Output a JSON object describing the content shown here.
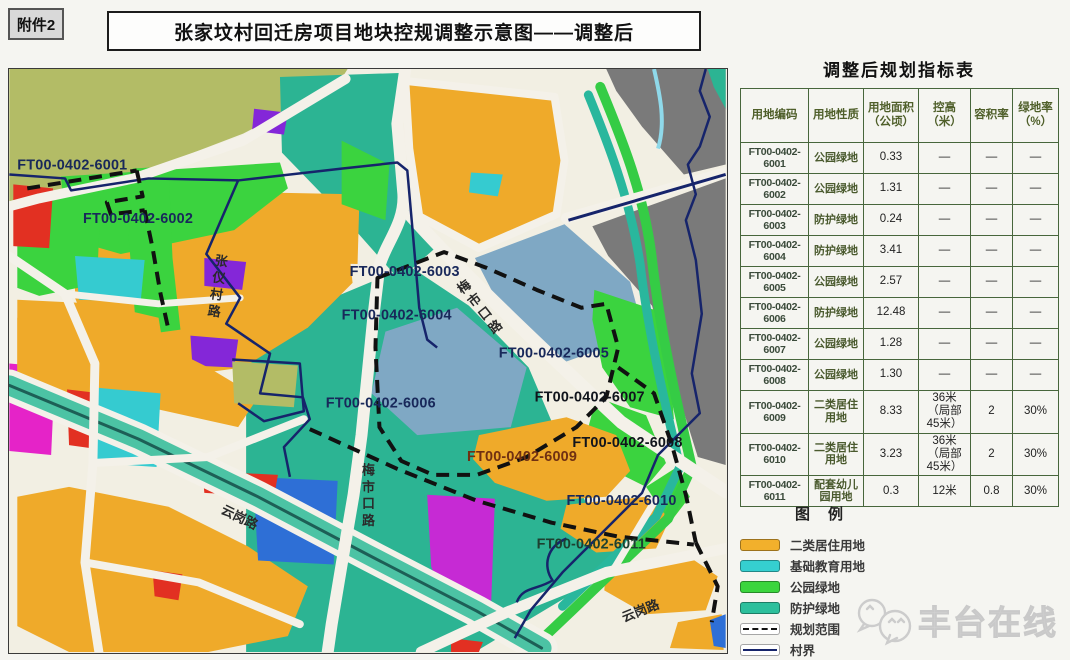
{
  "page": {
    "attachment_label": "附件2",
    "title": "张家坟村回迁房项目地块控规调整示意图——调整后"
  },
  "map": {
    "plot_labels": [
      {
        "text": "FT00-0402-6001",
        "x": 8,
        "y": 101,
        "color": "#18285a"
      },
      {
        "text": "FT00-0402-6002",
        "x": 74,
        "y": 155,
        "color": "#18285a"
      },
      {
        "text": "FT00-0402-6003",
        "x": 342,
        "y": 208,
        "color": "#18285a"
      },
      {
        "text": "FT00-0402-6004",
        "x": 334,
        "y": 252,
        "color": "#18285a"
      },
      {
        "text": "FT00-0402-6005",
        "x": 492,
        "y": 290,
        "color": "#18285a"
      },
      {
        "text": "FT00-0402-6006",
        "x": 318,
        "y": 340,
        "color": "#18285a"
      },
      {
        "text": "FT00-0402-6007",
        "x": 528,
        "y": 334,
        "color": "#10141c"
      },
      {
        "text": "FT00-0402-6008",
        "x": 566,
        "y": 380,
        "color": "#10141c"
      },
      {
        "text": "FT00-0402-6009",
        "x": 460,
        "y": 394,
        "color": "#703012"
      },
      {
        "text": "FT00-0402-6010",
        "x": 560,
        "y": 438,
        "color": "#18285a"
      },
      {
        "text": "FT00-0402-6011",
        "x": 530,
        "y": 482,
        "color": "#1d4030"
      }
    ],
    "road_labels": [
      {
        "text": "张仪村路",
        "x": 213,
        "y": 186,
        "rotate": 8,
        "vertical": true
      },
      {
        "text": "梅市口路",
        "x": 452,
        "y": 214,
        "rotate": -38,
        "vertical": true
      },
      {
        "text": "梅市口路",
        "x": 360,
        "y": 396,
        "rotate": 0,
        "vertical": true
      },
      {
        "text": "云岗路",
        "x": 618,
        "y": 556,
        "rotate": -22,
        "vertical": false
      },
      {
        "text": "云岗路",
        "x": 212,
        "y": 446,
        "rotate": 26,
        "vertical": false
      }
    ]
  },
  "panel": {
    "table_title": "调整后规划指标表",
    "table": {
      "headers": [
        "用地编码",
        "用地性质",
        "用地面积（公顷）",
        "控高（米）",
        "容积率",
        "绿地率（%）"
      ],
      "rows": [
        [
          "FT00-0402-6001",
          "公园绿地",
          "0.33",
          "—",
          "—",
          "—"
        ],
        [
          "FT00-0402-6002",
          "公园绿地",
          "1.31",
          "—",
          "—",
          "—"
        ],
        [
          "FT00-0402-6003",
          "防护绿地",
          "0.24",
          "—",
          "—",
          "—"
        ],
        [
          "FT00-0402-6004",
          "防护绿地",
          "3.41",
          "—",
          "—",
          "—"
        ],
        [
          "FT00-0402-6005",
          "公园绿地",
          "2.57",
          "—",
          "—",
          "—"
        ],
        [
          "FT00-0402-6006",
          "防护绿地",
          "12.48",
          "—",
          "—",
          "—"
        ],
        [
          "FT00-0402-6007",
          "公园绿地",
          "1.28",
          "—",
          "—",
          "—"
        ],
        [
          "FT00-0402-6008",
          "公园绿地",
          "1.30",
          "—",
          "—",
          "—"
        ],
        [
          "FT00-0402-6009",
          "二类居住用地",
          "8.33",
          "36米（局部45米）",
          "2",
          "30%"
        ],
        [
          "FT00-0402-6010",
          "二类居住用地",
          "3.23",
          "36米（局部45米）",
          "2",
          "30%"
        ],
        [
          "FT00-0402-6011",
          "配套幼儿园用地",
          "0.3",
          "12米",
          "0.8",
          "30%"
        ]
      ]
    },
    "legend": {
      "title": "图例",
      "items": [
        {
          "label": "二类居住用地",
          "type": "fill",
          "color": "#f2b02c"
        },
        {
          "label": "基础教育用地",
          "type": "fill",
          "color": "#35cfd0"
        },
        {
          "label": "公园绿地",
          "type": "fill",
          "color": "#3bd53e"
        },
        {
          "label": "防护绿地",
          "type": "fill",
          "color": "#2cbf9c"
        },
        {
          "label": "规划范围",
          "type": "dashed-line",
          "color": "#111111"
        },
        {
          "label": "村界",
          "type": "solid-line",
          "color": "#16246b"
        }
      ]
    },
    "watermark": "丰台在线"
  },
  "colors": {
    "residential_orange": "#efaa2a",
    "education_cyan": "#35cbd0",
    "park_green": "#3bd33f",
    "buffer_teal": "#2cb493",
    "village_boundary_navy": "#16246b",
    "planning_boundary_black": "#111111",
    "existing_gray": "#7a7a7a",
    "site_steel_blue": "#7fa8c4",
    "olive": "#b3bc66",
    "road_cream": "#f2efe3"
  }
}
